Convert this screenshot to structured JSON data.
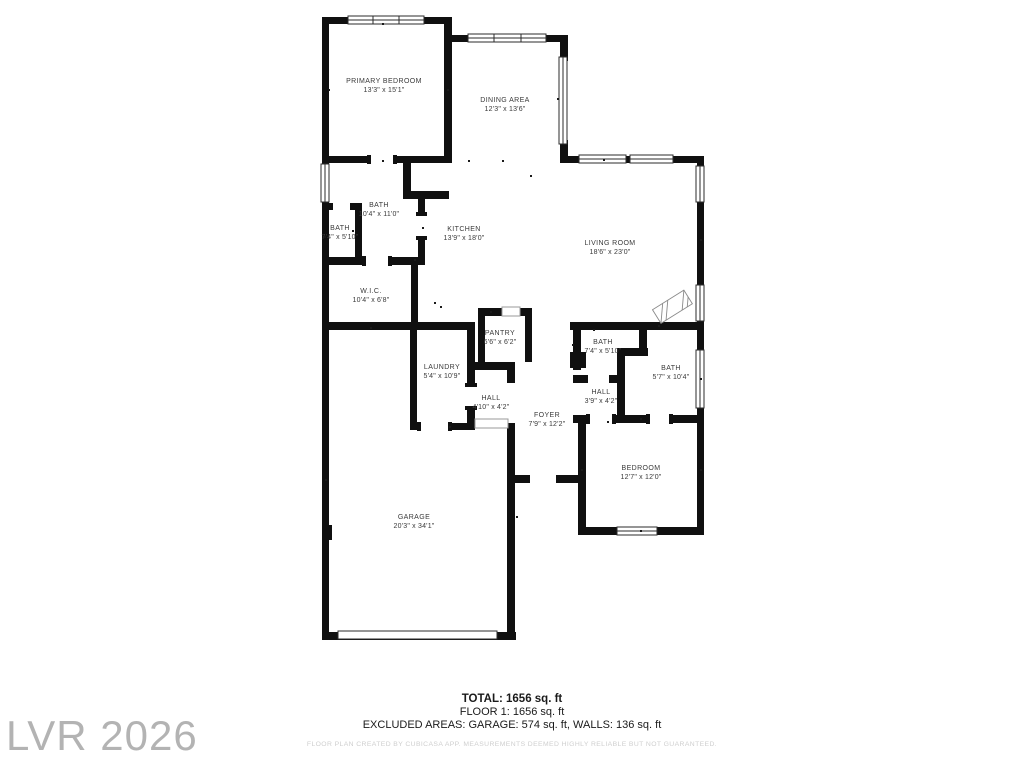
{
  "watermark": "LVR 2026",
  "rooms": {
    "primary_bedroom": {
      "name": "PRIMARY BEDROOM",
      "dims": "13'3\" x 15'1\""
    },
    "dining": {
      "name": "DINING AREA",
      "dims": "12'3\" x 13'6\""
    },
    "bath_main": {
      "name": "BATH",
      "dims": "10'4\" x 11'0\""
    },
    "bath_small": {
      "name": "BATH",
      "dims": "7'4\" x 5'10\""
    },
    "kitchen": {
      "name": "KITCHEN",
      "dims": "13'9\" x 18'0\""
    },
    "living": {
      "name": "LIVING ROOM",
      "dims": "18'6\" x 23'0\""
    },
    "wic": {
      "name": "W.I.C.",
      "dims": "10'4\" x 6'8\""
    },
    "pantry": {
      "name": "PANTRY",
      "dims": "6'6\" x 6'2\""
    },
    "laundry": {
      "name": "LAUNDRY",
      "dims": "5'4\" x 10'9\""
    },
    "hall_left": {
      "name": "HALL",
      "dims": "4'10\" x 4'2\""
    },
    "foyer": {
      "name": "FOYER",
      "dims": "7'9\" x 12'2\""
    },
    "bath_right_small": {
      "name": "BATH",
      "dims": "7'4\" x 5'10\""
    },
    "hall_right": {
      "name": "HALL",
      "dims": "3'9\" x 4'2\""
    },
    "bath_right": {
      "name": "BATH",
      "dims": "5'7\" x 10'4\""
    },
    "bedroom": {
      "name": "BEDROOM",
      "dims": "12'7\" x 12'0\""
    },
    "garage": {
      "name": "GARAGE",
      "dims": "20'3\" x 34'1\""
    }
  },
  "summary": {
    "total": "TOTAL: 1656 sq. ft",
    "floor": "FLOOR 1: 1656 sq. ft",
    "excluded": "EXCLUDED AREAS: GARAGE: 574 sq. ft, WALLS: 136 sq. ft",
    "disclaimer": "FLOOR PLAN CREATED BY CUBICASA APP. MEASUREMENTS DEEMED HIGHLY RELIABLE BUT NOT GUARANTEED."
  },
  "colors": {
    "wall": "#101010",
    "label": "#3a3a3a",
    "watermark": "#b3b3b3",
    "disclaimer": "#cfcfcf"
  }
}
